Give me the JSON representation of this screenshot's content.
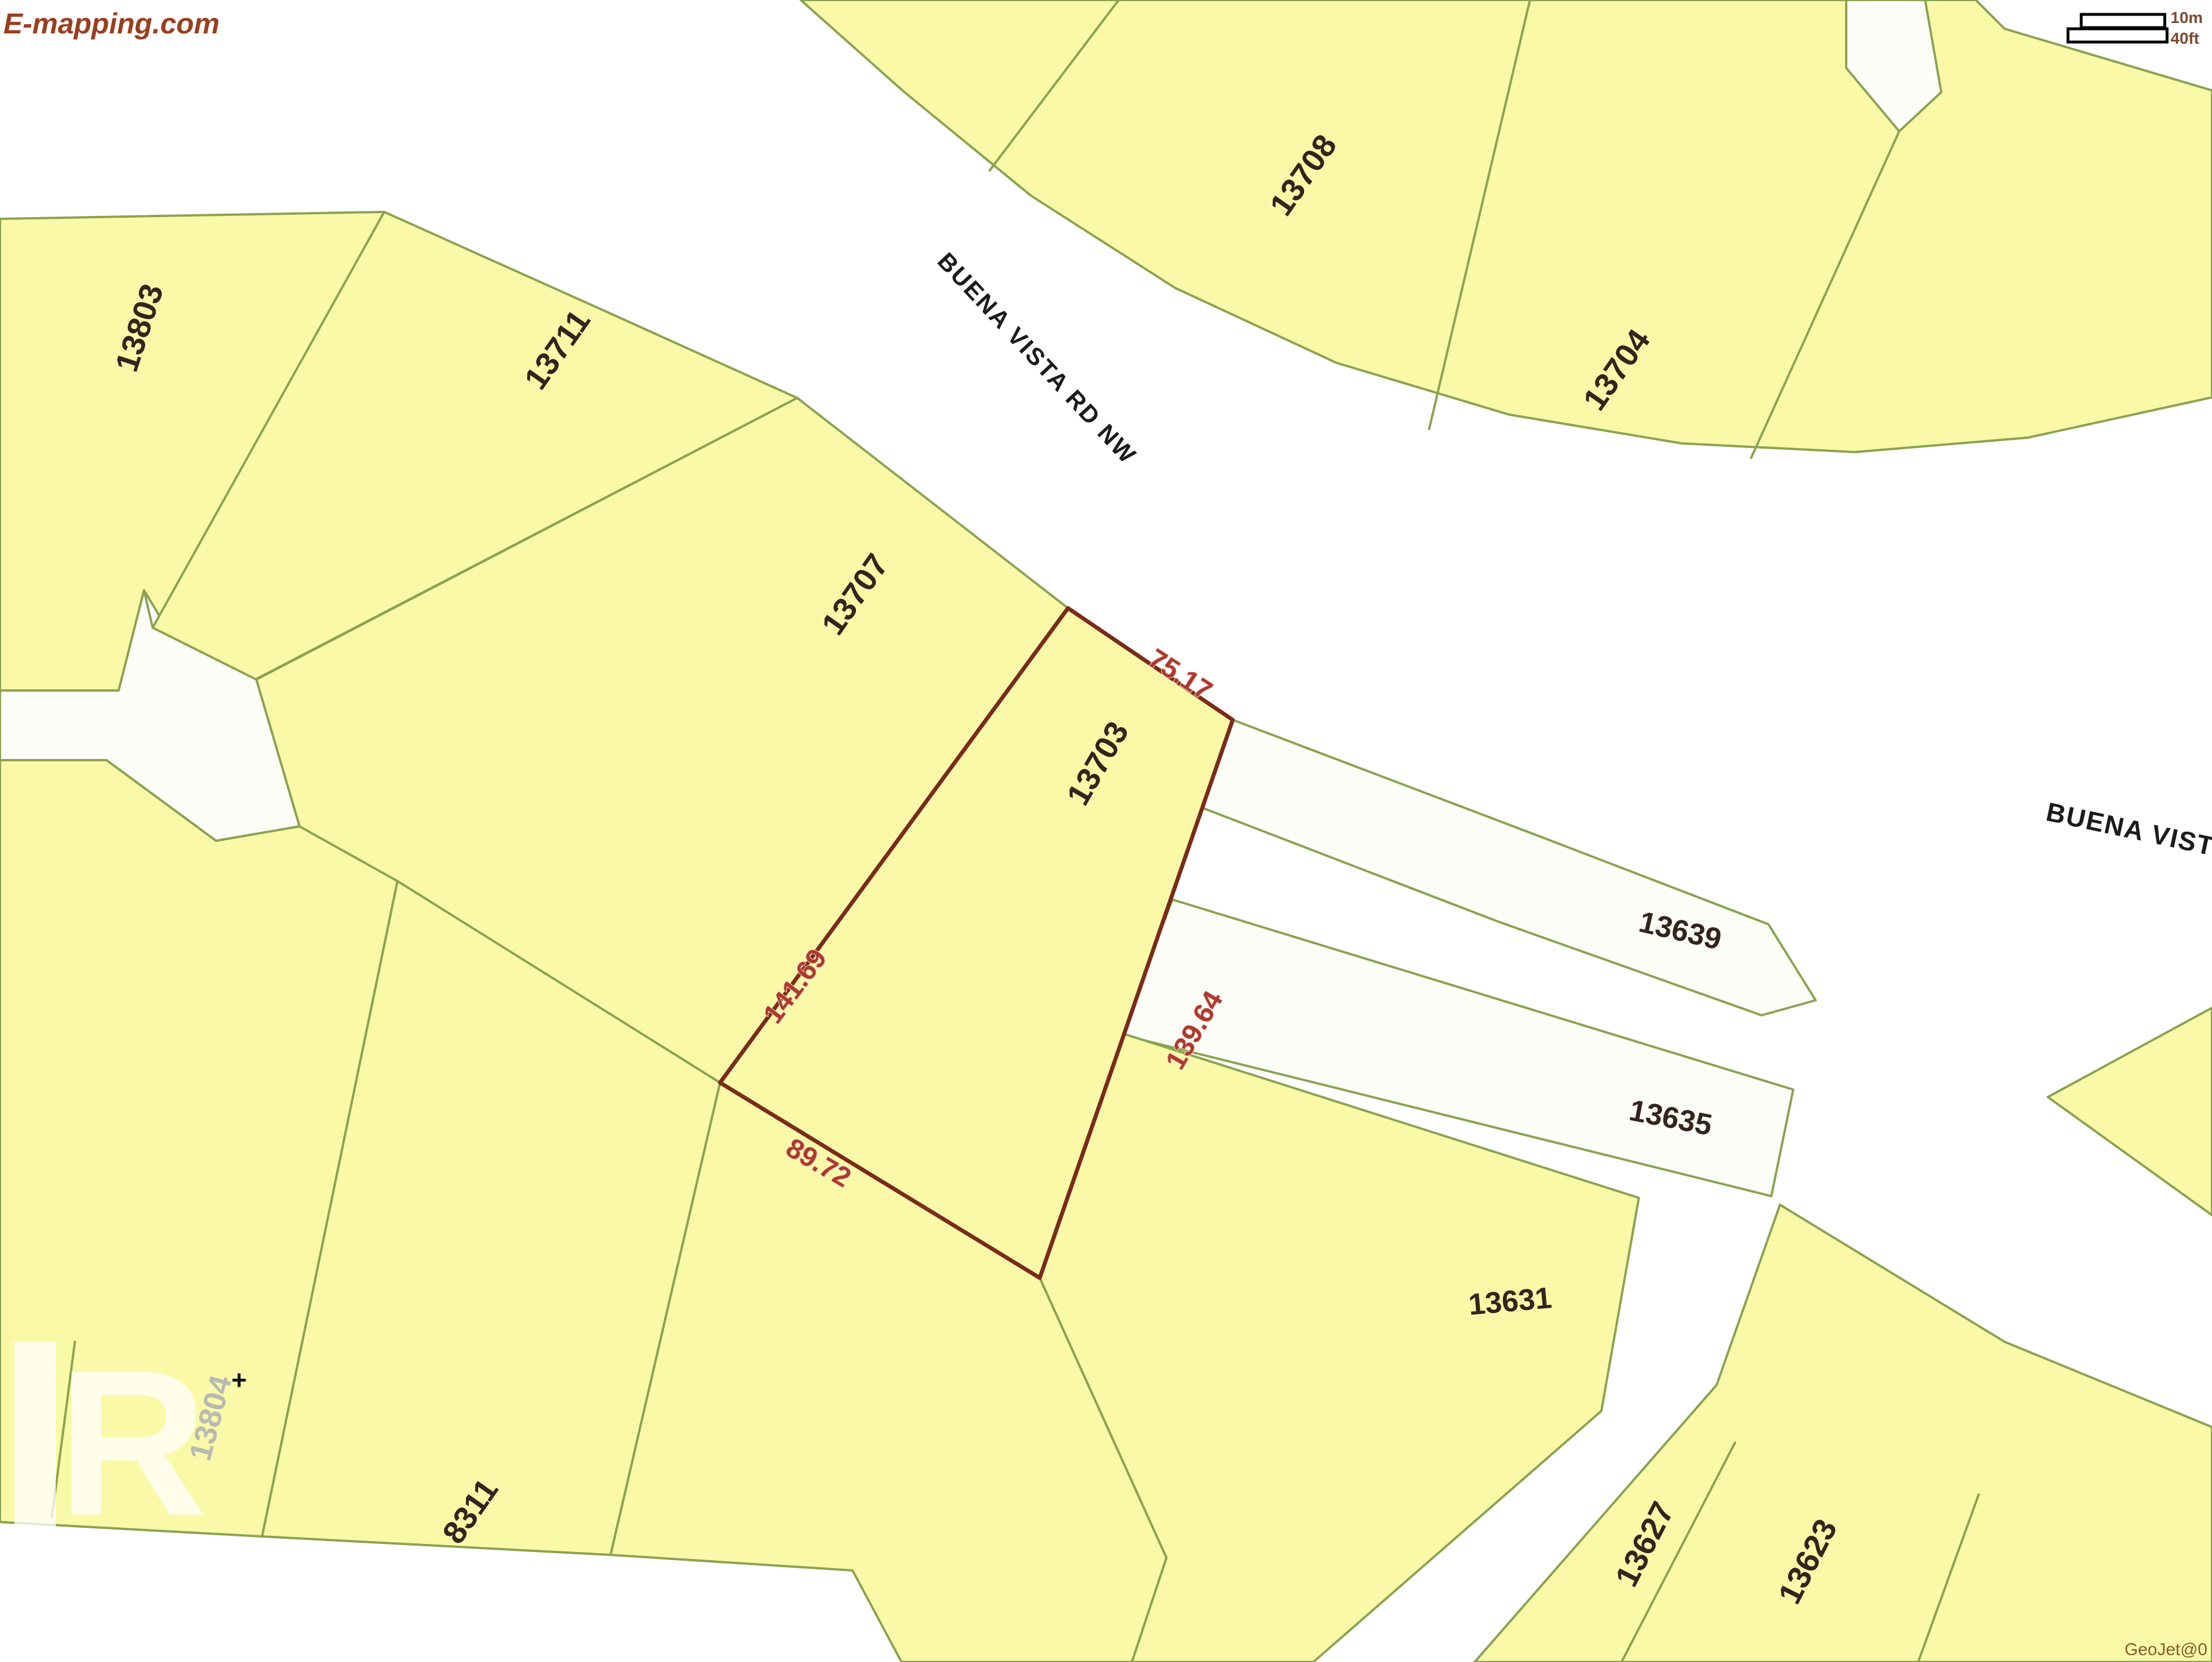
{
  "map": {
    "logo_text": "E-mapping.com",
    "attribution": "GeoJet@0",
    "scale_bar": {
      "metric": "10m",
      "imperial": "40ft"
    },
    "streets": [
      {
        "name": "BUENA VISTA RD NW"
      },
      {
        "name": "BUENA VIST"
      }
    ],
    "parcels": [
      {
        "id": "13803"
      },
      {
        "id": "13711"
      },
      {
        "id": "13707"
      },
      {
        "id": "13708"
      },
      {
        "id": "13704"
      },
      {
        "id": "13639"
      },
      {
        "id": "13635"
      },
      {
        "id": "13631"
      },
      {
        "id": "13627"
      },
      {
        "id": "13623"
      },
      {
        "id": "8311"
      }
    ],
    "selected_parcel": {
      "id": "13703",
      "dimensions": {
        "top": "75.17",
        "left": "141.69",
        "right": "139.64",
        "bottom": "89.72"
      }
    },
    "watermark": {
      "parcel_id": "13804",
      "cross": "+",
      "logo_letter": "R"
    },
    "colors": {
      "parcel_fill": "#f9f9a8",
      "parcel_border": "#8aa351",
      "selected_border": "#7a2b1a",
      "dimension_text": "#ad3a2d",
      "label_text": "#33241c",
      "street_text": "#1b1b1b",
      "logo_text": "#993f1f",
      "road_fill": "#ffffff"
    }
  }
}
